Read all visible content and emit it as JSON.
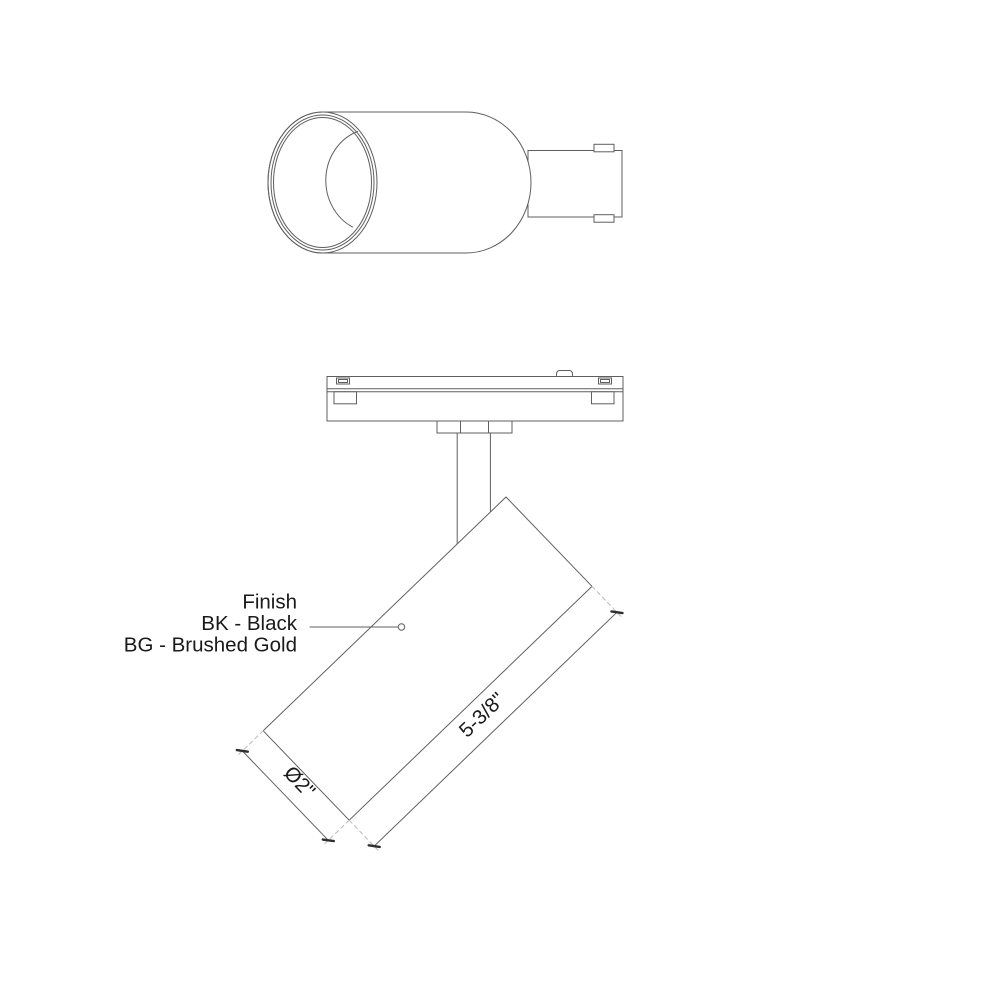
{
  "colors": {
    "line": "#5f5f5f",
    "dash": "#b9b9b9",
    "tick": "#2e2e2e",
    "text": "#1a1a1a",
    "background": "#ffffff"
  },
  "labels": {
    "finish": {
      "title": "Finish",
      "option_bk": "BK - Black",
      "option_bg": "BG - Brushed Gold"
    },
    "dimensions": {
      "length": "5-3/8\"",
      "diameter": "Ø2\""
    }
  }
}
